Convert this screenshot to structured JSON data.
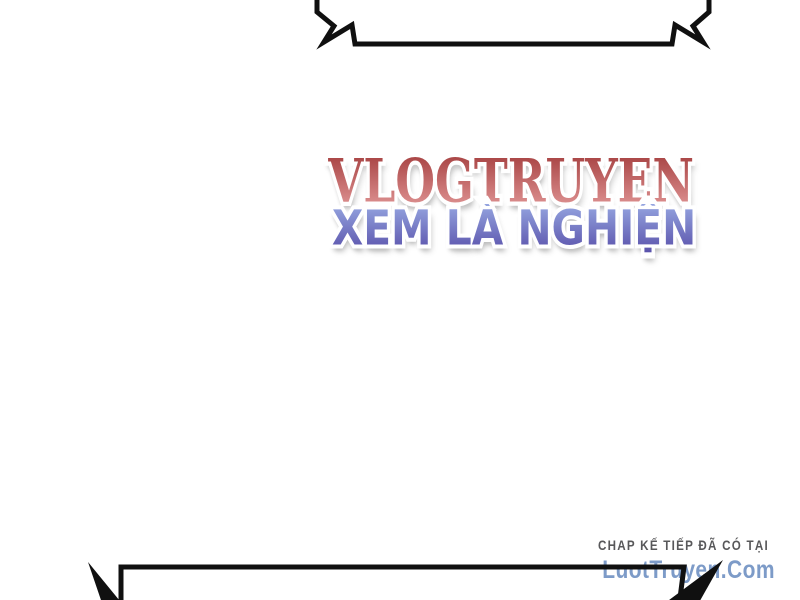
{
  "page": {
    "type": "comic-page-scan"
  },
  "colors": {
    "background": "#ffffff",
    "bubble-stroke": "#101010",
    "outline": "#ffffff",
    "shadow": "#bdbdbd",
    "title-grad-top": "#a43e3e",
    "title-grad-bottom": "#e29898",
    "title-fallback": "#c26060",
    "subtitle-grad-top": "#95a5e0",
    "subtitle-grad-bottom": "#5a52ab",
    "subtitle-fallback": "#7276c8",
    "credit-heading": "#58585a",
    "credit-site": "#7d9bc8"
  },
  "watermark": {
    "title": "VLOGTRUYEN",
    "subtitle": "XEM LÀ NGHIỆN"
  },
  "credit": {
    "heading": "CHAP KẾ TIẾP ĐÃ CÓ TẠI",
    "site": "LuotTruyen.Com"
  }
}
